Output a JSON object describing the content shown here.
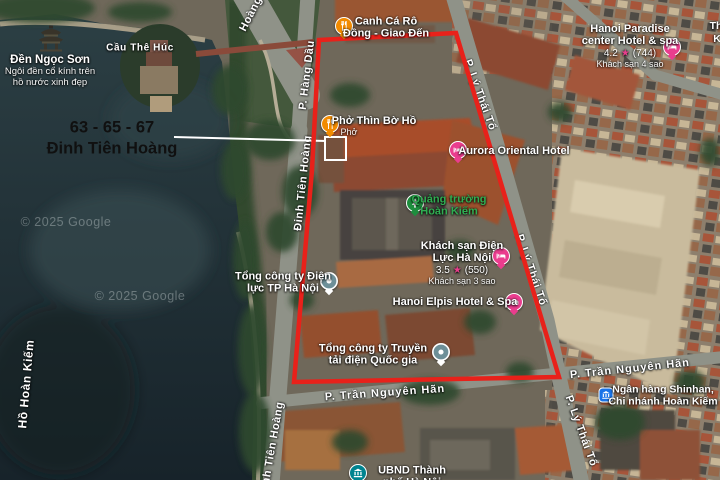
{
  "annotation": {
    "address_line1": "63 - 65 - 67",
    "address_line2": "Đinh Tiên Hoàng"
  },
  "watermark": {
    "copyright": "© 2025 Google"
  },
  "streets": {
    "hang_dau": "P. Hàng Dầu",
    "dinh_tien_hoang": "Đinh Tiên Hoàng",
    "dinh_tien_hoang_fragment": "Hoàng",
    "ly_thai_to": "P. Lý Thái Tổ",
    "tran_nguyen_han": "P. Trần Nguyên Hãn",
    "cau_the_huc": "Cầu Thê Húc",
    "ho_hoan_kiem": "Hồ Hoàn Kiếm"
  },
  "pois": {
    "den_ngoc_son": {
      "title": "Đền Ngọc Sơn",
      "desc1": "Ngôi đền cổ kính trên",
      "desc2": "hồ nước xinh đẹp"
    },
    "canh_ca_ro": {
      "line1": "Canh Cá Rô",
      "line2": "Đồng - Giao Đến"
    },
    "pho_thin": {
      "title": "Phở Thìn Bờ Hồ",
      "category": "Phở"
    },
    "aurora": {
      "title": "Aurora Oriental Hotel"
    },
    "hanoi_paradise": {
      "line1": "Hanoi Paradise",
      "line2": "center Hotel & spa",
      "rating": "4.2",
      "star": "★",
      "reviews": "(744)",
      "category": "Khách sạn 4 sao"
    },
    "quang_truong": {
      "line1": "Quảng trường",
      "line2": "Hoàn Kiếm"
    },
    "dien_luc_hotel": {
      "line1": "Khách sạn Điện",
      "line2": "Lực Hà Nội",
      "rating": "3.5",
      "star": "★",
      "reviews": "(550)",
      "category": "Khách sạn 3 sao"
    },
    "evn_hanoi": {
      "line1": "Tổng công ty Điện",
      "line2": "lực TP Hà Nội"
    },
    "hanoi_elpis": {
      "title": "Hanoi Elpis Hotel & Spa"
    },
    "evn_npt": {
      "line1": "Tổng công ty Truyền",
      "line2": "tải điện Quốc gia"
    },
    "shinhan_bank": {
      "line1": "Ngân hàng Shinhan,",
      "line2": "Chi nhánh Hoàn Kiếm"
    },
    "ubnd": {
      "line1": "UBND Thành",
      "line2": "phố Hà Nội"
    },
    "edge_fragment": {
      "line1": "Th",
      "line2": "K"
    }
  },
  "colors": {
    "boundary_red": "#e8211a",
    "property_outline_white": "#ffffff",
    "restaurant_orange": "#f28b00",
    "hotel_pink": "#ea3d8e",
    "park_green": "#1e8e3e",
    "park_text_green": "#2fae52",
    "bank_blue": "#1a73e8",
    "government_teal": "#00838f",
    "company_slate": "#6d8f98",
    "label_white": "#ffffff",
    "callout_black": "#101010"
  }
}
